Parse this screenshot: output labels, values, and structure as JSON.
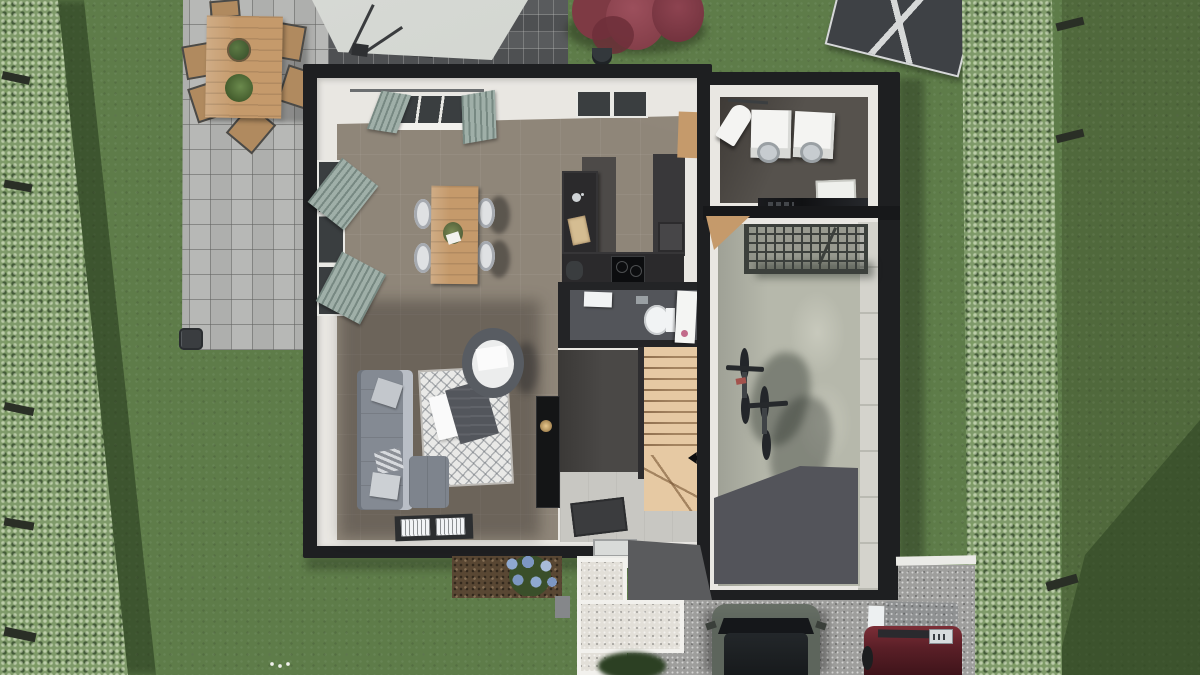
{
  "scene": {
    "title": "3D top-down render of a house ground floor with garden, patio, garage and driveway",
    "view": "top-down isometric render",
    "rooms": [
      {
        "name": "living-dining-kitchen",
        "items": [
          "dining table",
          "four chairs",
          "kitchen island with sink and cutting board",
          "worktop with cooktop",
          "tall cabinets",
          "corner sofa",
          "patterned rug",
          "round armchair",
          "tv column",
          "floor windows"
        ]
      },
      {
        "name": "wc",
        "items": [
          "toilet",
          "hand basin",
          "door"
        ]
      },
      {
        "name": "entry-hall",
        "items": [
          "staircase with winder steps",
          "doormat",
          "front door"
        ]
      },
      {
        "name": "laundry-room",
        "items": [
          "washing machine",
          "dryer",
          "ironing board",
          "laundry basket",
          "black counter"
        ]
      },
      {
        "name": "garage",
        "items": [
          "suspended wire rack",
          "two bicycles",
          "garage door"
        ]
      }
    ],
    "exterior": [
      "boundary hedges",
      "paved patio",
      "outdoor dining table with six chairs",
      "cantilever parasol",
      "barbecue",
      "red shrub",
      "greenhouse",
      "hydrangea flower bed",
      "white gravel path",
      "driveway",
      "dark grey car",
      "red car",
      "white curb and post"
    ]
  },
  "colors": {
    "lawn": "#5e7c49",
    "lawn2": "#50693c",
    "shadowgreen": "#2c4220",
    "hedge": "#7f9a6a",
    "post": "#2a2f26",
    "paver": "#b7b8b6",
    "paver2": "#595b5d",
    "canopy": "#cdd0cb",
    "ghouse": "#3e4145",
    "bushred": "#7e3a44",
    "bushred2": "#93475230",
    "wallb": "#1e1f21",
    "wallw": "#e9e7e2",
    "floor": "#8f8679",
    "wood": "#c59a6b",
    "woodlt": "#d8b98e",
    "stair": "#e6c9a3",
    "entry": "#c8c7c2",
    "media": "#4a4846",
    "tv": "#141516",
    "curtain": "#9fafa8",
    "glass": "#3a3e40",
    "frame": "#e9e9e5",
    "chairw": "#dfe1e3",
    "island": "#2b2a2c",
    "counter": "#4d4a48",
    "cabinet": "#39383a",
    "cooktop": "#0c0d0f",
    "board": "#d5bd92",
    "wcfloor": "#53555a",
    "toilet": "#f1f3f4",
    "sofa": "#848a93",
    "sofalt": "#b9bec6",
    "rug": "#e9e9e7",
    "throw": "#53565c",
    "mat": "#3b3c3e",
    "lfloor": "#56524d",
    "washer": "#f4f4f2",
    "gloss": "#101113",
    "gfloor": "#b6b8ab",
    "gdark": "#53545a",
    "rack": "#3c403c",
    "bike": "#23262a",
    "pathc": "#e2dfd8",
    "pathb": "#f2f1ed",
    "mulch": "#594733",
    "hyd1": "#8fa9d0",
    "hyd2": "#7d97c2",
    "hyd3": "#a7bcda",
    "drive": "#9e9e9c",
    "apron": "#5a5b5d",
    "curb": "#ebebe7",
    "cardark": "#5d655c",
    "carroof": "#23272a",
    "carred": "#5a1f27",
    "cover": "#8f9192",
    "plate": "#d8dcde",
    "bushdark": "#2c4023"
  }
}
